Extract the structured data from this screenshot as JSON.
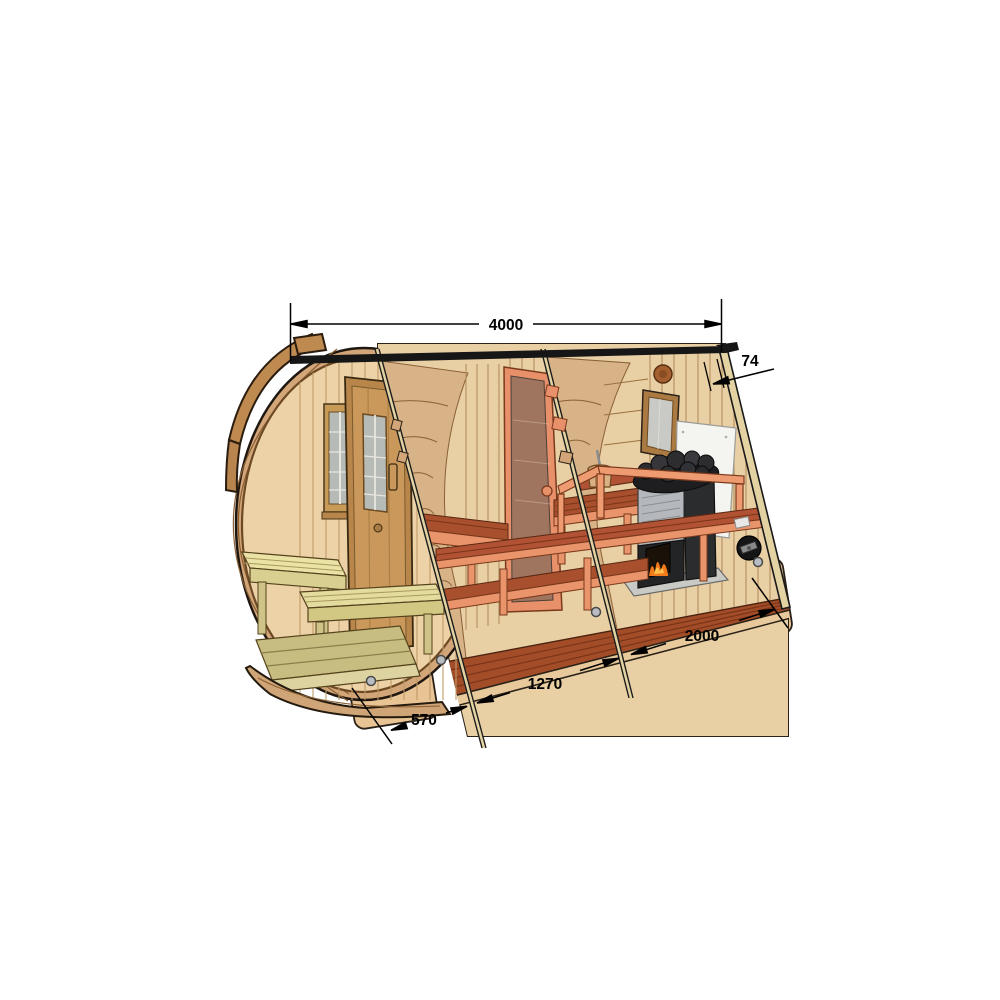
{
  "diagram": {
    "kind": "barrel-sauna-cutaway-dimension-drawing",
    "dimensions": {
      "overall_length": "4000",
      "wall_thickness": "74",
      "sauna_room_length": "2000",
      "changing_room_length": "1270",
      "porch_length": "570"
    },
    "parts": [
      "outer barrel shell",
      "roof strip",
      "entrance door",
      "front window",
      "porch benches",
      "porch deck",
      "changing room benches",
      "glass door",
      "sauna benches",
      "wood-fired sauna heater",
      "heater stones",
      "heat shield panel",
      "water bucket with ladle",
      "back-wall window",
      "round air vent",
      "sliding air vent",
      "support cradles",
      "cut-plane rods"
    ],
    "colors": {
      "background": "#ffffff",
      "wood_light": "#ecd2a6",
      "wood_mid": "#d2a678",
      "wood_dark": "#bf8a50",
      "interior_wall": "#e9cfa4",
      "bench_red": "#a8502e",
      "trim_salmon": "#ea946c",
      "porch_pale": "#e9e0a2",
      "floor_red": "#a34d28",
      "stove_body": "#2b2c2e",
      "stove_panel": "#b4b8bc",
      "fire_orange": "#f47b1c",
      "heat_shield": "#f4f4f1",
      "line": "#1a1a1a"
    }
  }
}
